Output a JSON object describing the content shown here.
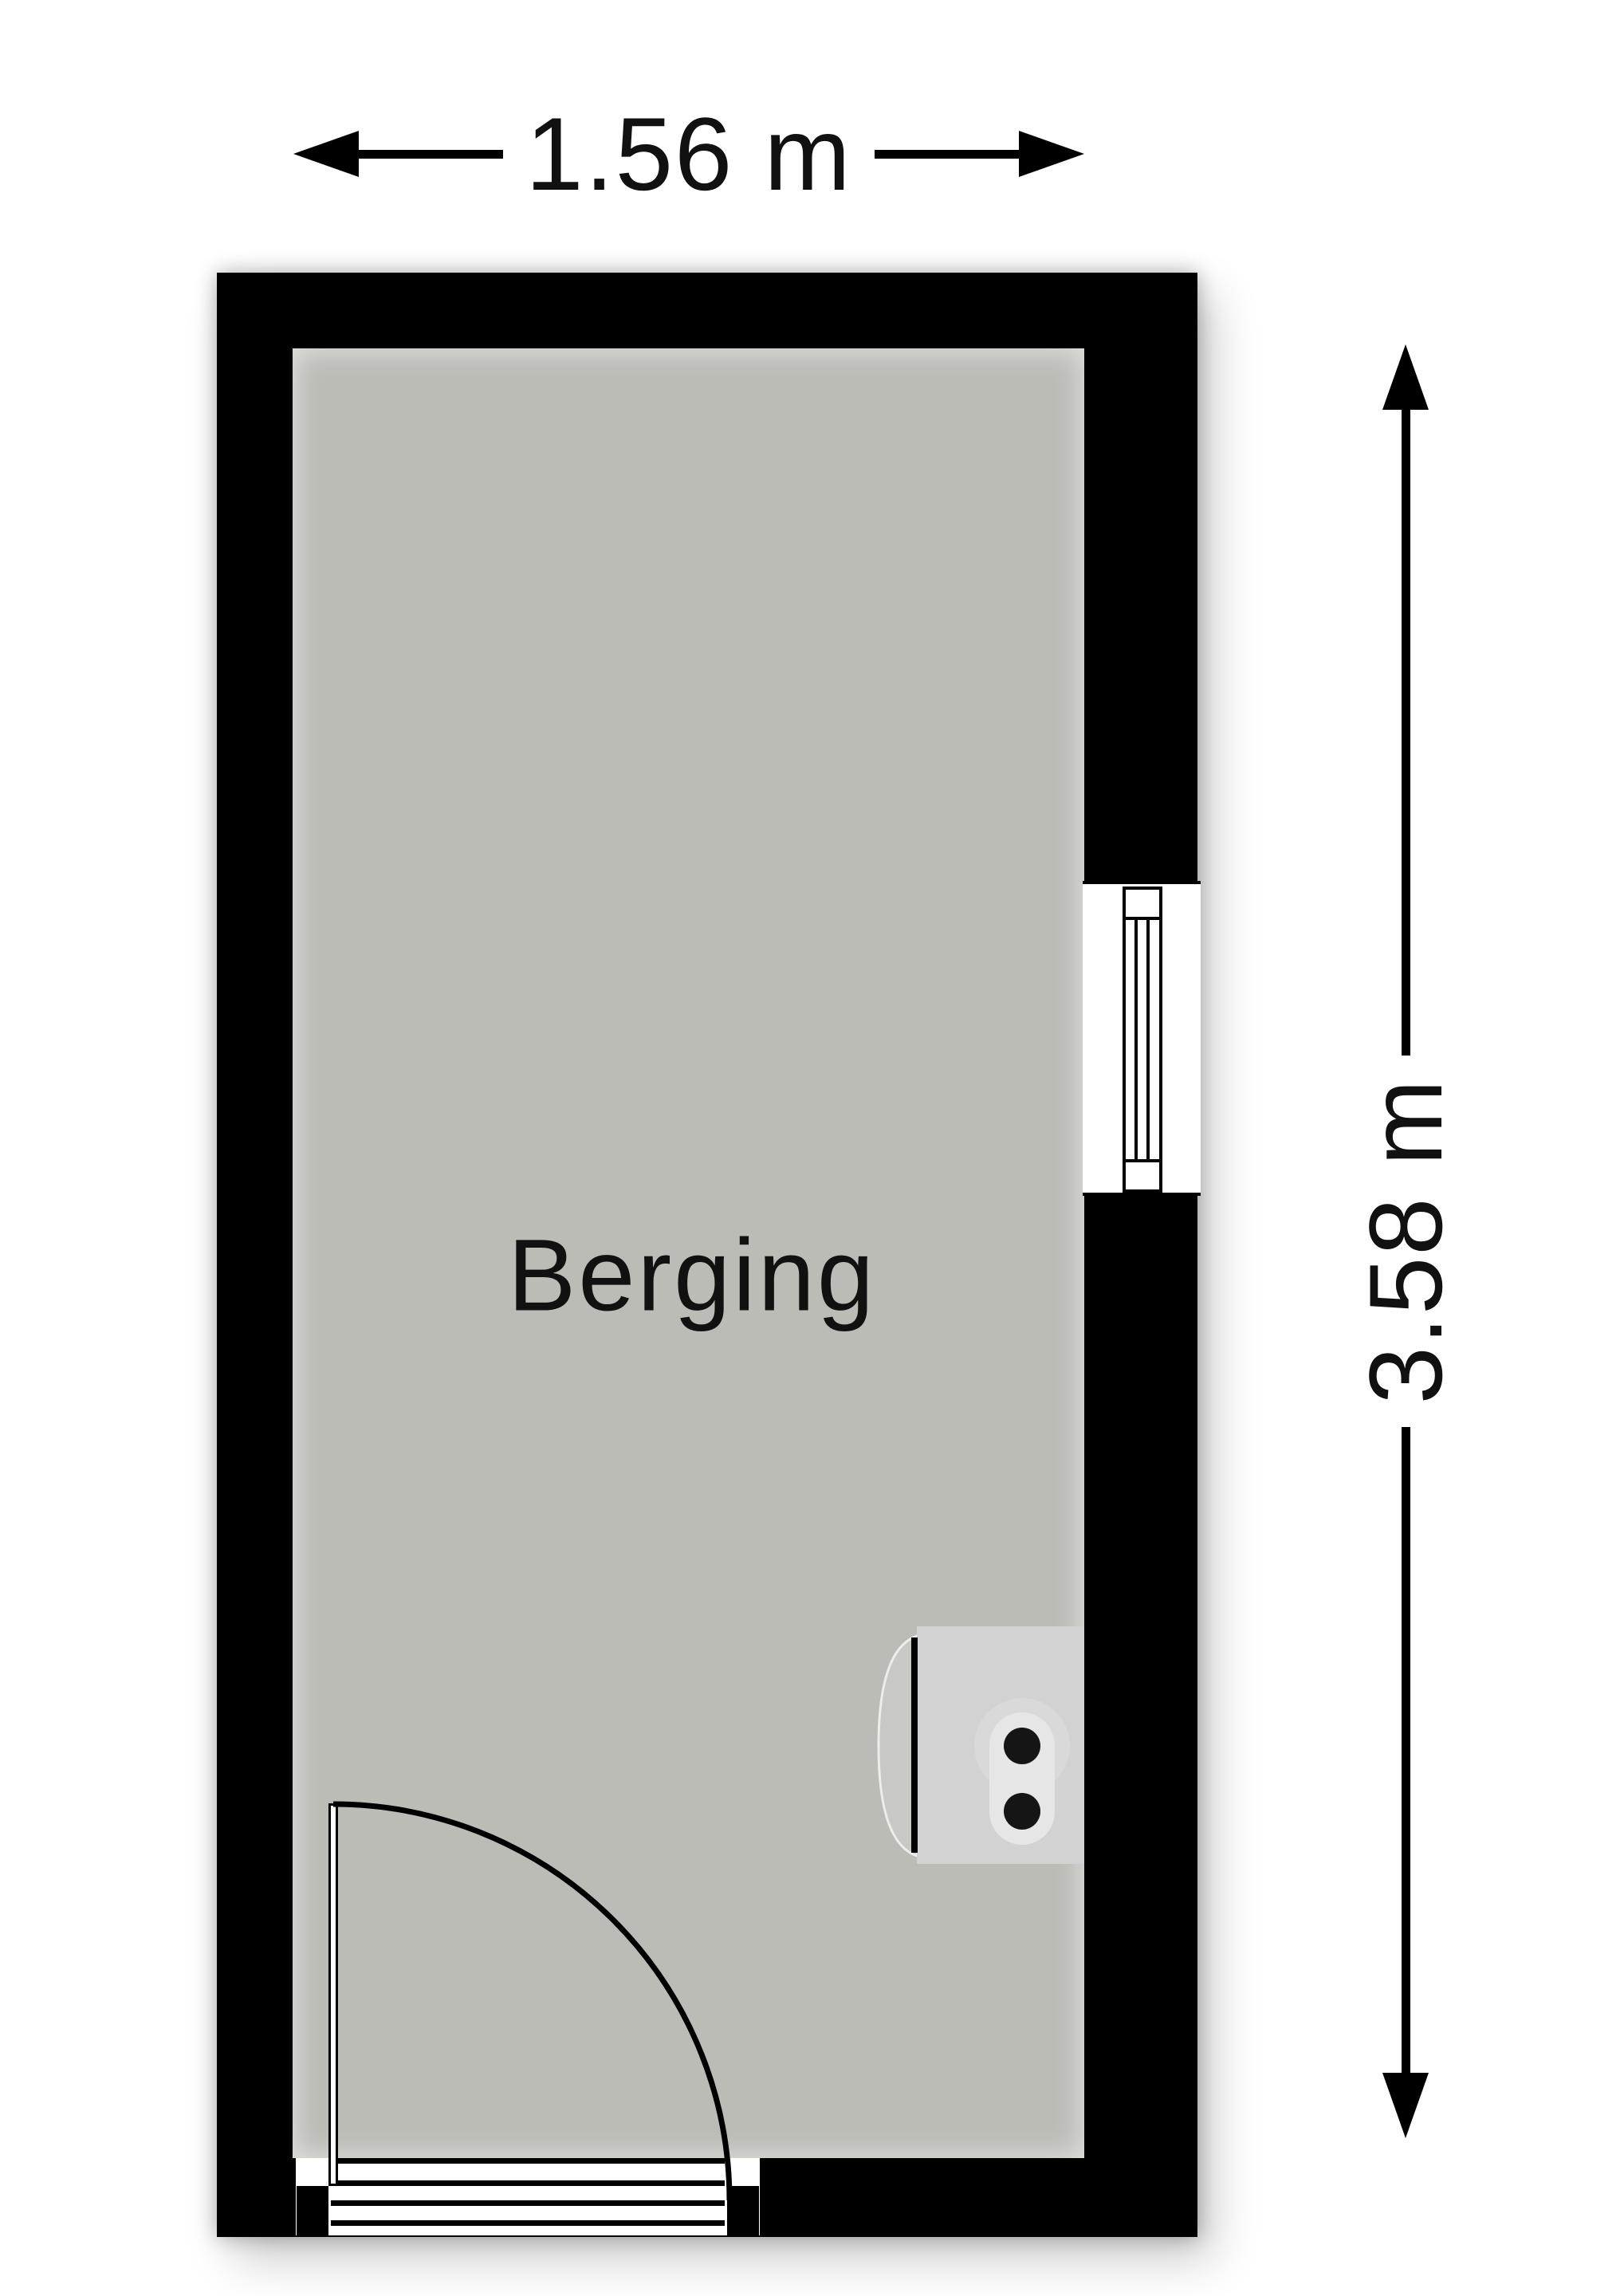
{
  "room": {
    "label": "Berging"
  },
  "dimensions": {
    "width": {
      "label": "1.56 m"
    },
    "height": {
      "label": "3.58 m"
    }
  },
  "colors": {
    "background": "#ffffff",
    "wall": "#000000",
    "line": "#000000",
    "text": "#111111",
    "floor": "#bbbcb6",
    "fixture_box": "#d2d2d3",
    "fixture_flap": "#c8c8c4",
    "fixture_flap_edge": "#ededea",
    "fixture_capsule": "#e6e6e7",
    "fixture_halo": "#d9d9da",
    "fixture_dot": "#151515"
  }
}
